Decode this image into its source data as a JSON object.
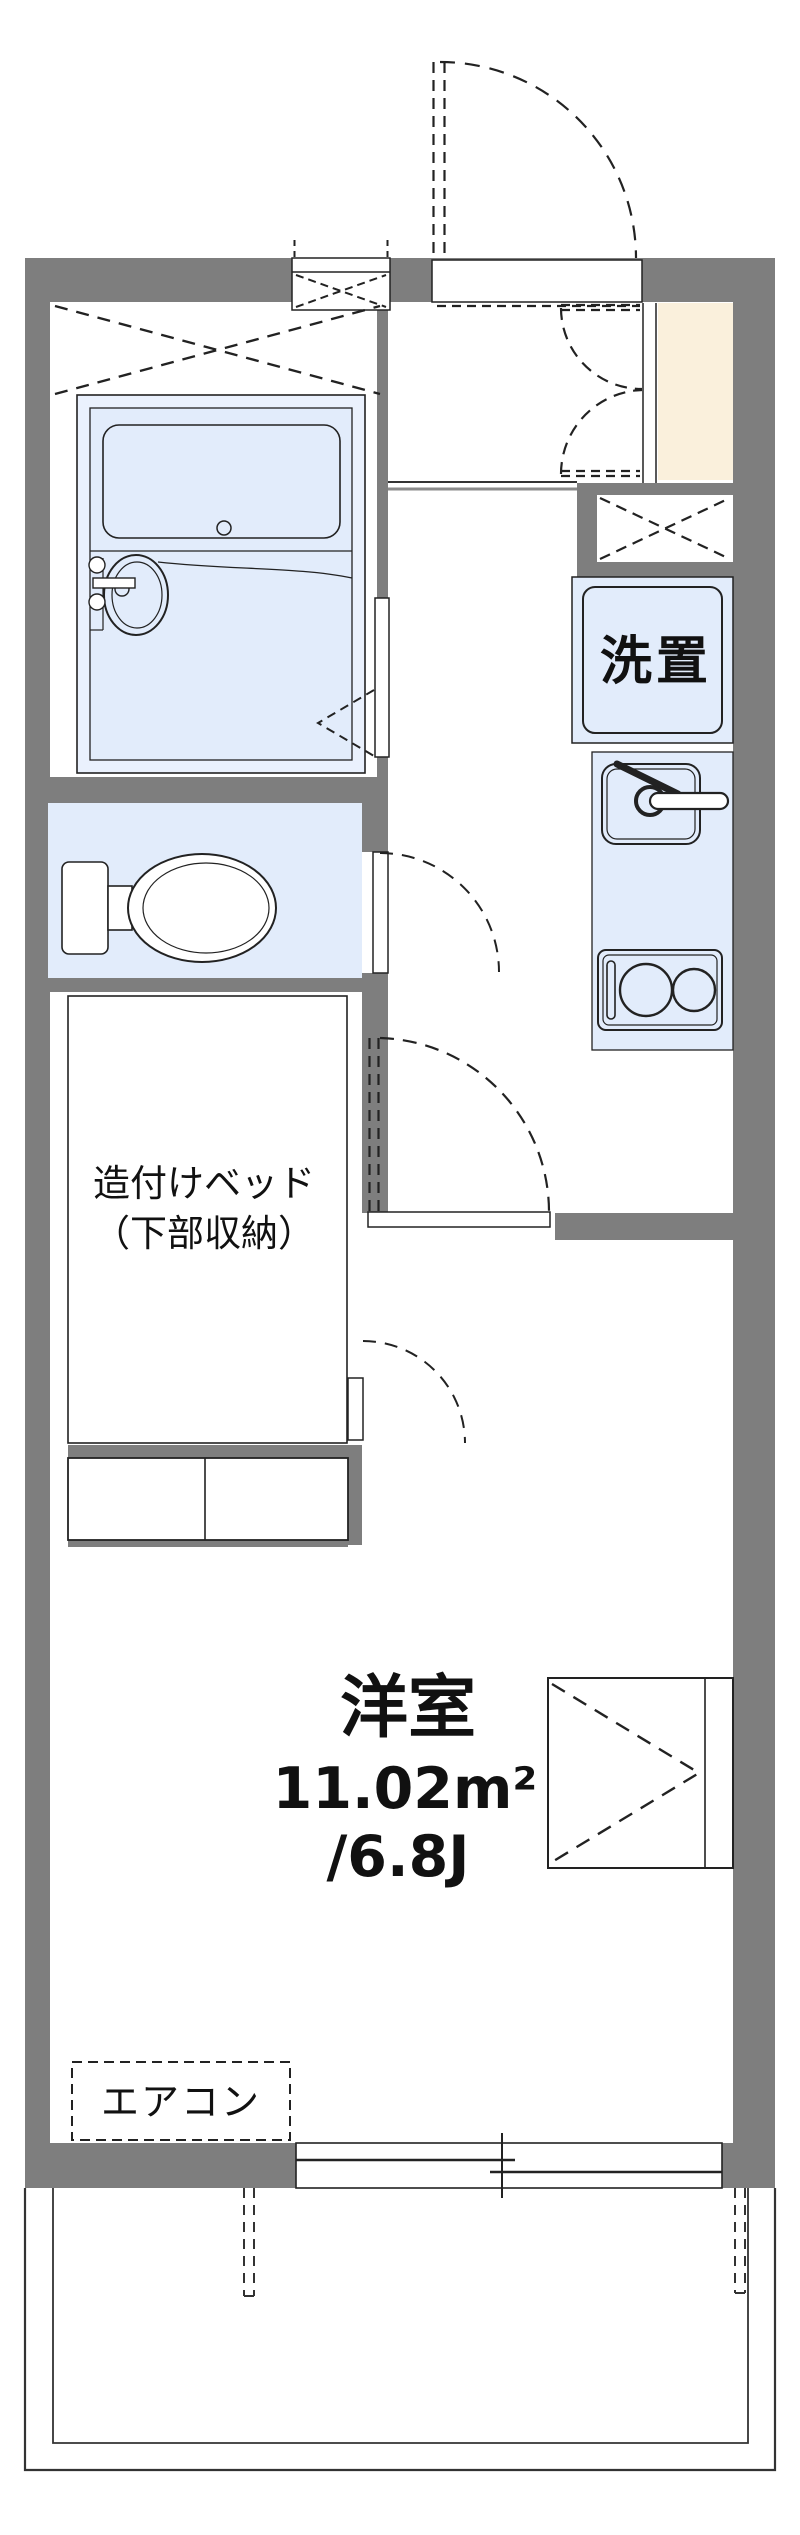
{
  "title": "apartment-floor-plan",
  "labels": {
    "washer": "洗置",
    "bed_line1": "造付けベッド",
    "bed_line2": "（下部収納）",
    "room_name": "洋室",
    "room_area_m2": "11.02m²",
    "room_area_jo": "/6.8J",
    "aircon": "エアコン"
  },
  "colors": {
    "wall_gray": "#7e7e7e",
    "fixture_blue": "#e2ecfb",
    "bath_blue": "#eaf1fd",
    "entrance_beige": "#faf0dc",
    "line_dark": "#222222",
    "background": "#ffffff"
  },
  "rooms": [
    {
      "name": "western-room",
      "label": "洋室",
      "area_m2": "11.02m²",
      "area_tatami": "/6.8J"
    },
    {
      "name": "unit-bath"
    },
    {
      "name": "toilet"
    },
    {
      "name": "built-in-bed",
      "label": "造付けベッド（下部収納）"
    },
    {
      "name": "kitchen-corridor"
    },
    {
      "name": "entrance-genkan"
    },
    {
      "name": "balcony"
    }
  ],
  "fixtures": [
    "bathtub",
    "washbasin",
    "toilet-bowl",
    "washing-machine-space",
    "kitchen-sink",
    "gas-stove",
    "closet",
    "air-conditioner",
    "sliding-window",
    "entrance-door",
    "pipe-space-vent"
  ]
}
